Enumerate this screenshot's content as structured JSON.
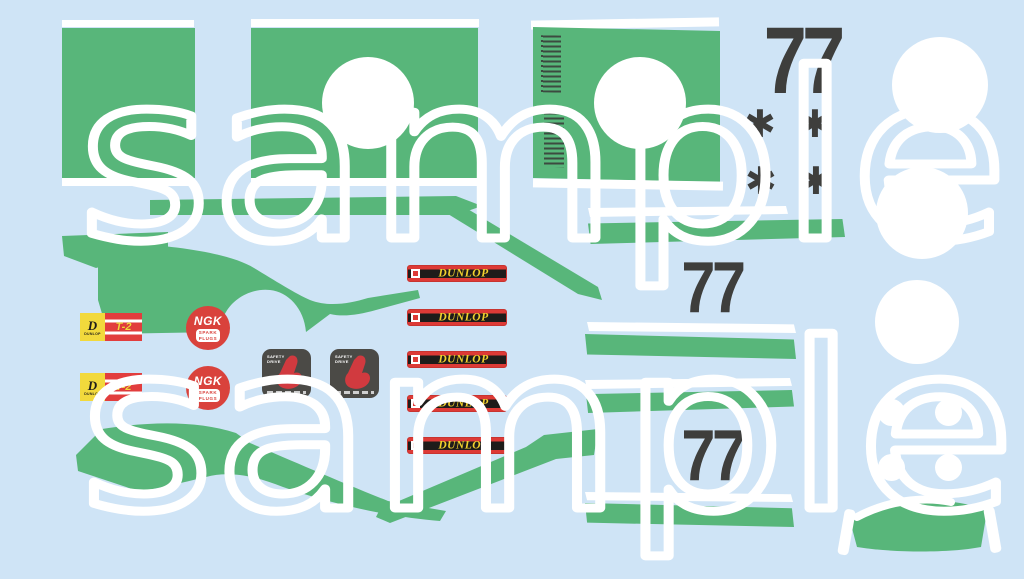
{
  "canvas": {
    "width": 1024,
    "height": 579,
    "background": "#cfe4f6"
  },
  "watermark": {
    "text": "sample",
    "color": "#ffffff"
  },
  "colors": {
    "panel_green": "#58b67a",
    "number_dark": "#3e3e3c",
    "roundel_white": "#ffffff",
    "dunlop_red": "#dd3a36",
    "dunlop_band_black": "#1e1c1a",
    "dunlop_yellow": "#f2d12d",
    "t2_yellow": "#f2d93c",
    "ngk_red": "#d9423c",
    "safety_gray": "#4b4a46",
    "safety_red": "#d13a3f"
  },
  "numbers": {
    "value": "77",
    "count": 3
  },
  "stars": {
    "glyph": "✱",
    "count": 4
  },
  "sponsors": {
    "dunlop_strip": {
      "label": "DUNLOP",
      "count": 5
    },
    "dunlop_t2": {
      "brand": "DUNLOP",
      "code": "T-2",
      "count": 2
    },
    "ngk": {
      "brand": "NGK",
      "line1": "SPARK",
      "line2": "PLUGS",
      "count": 2
    },
    "safety": {
      "line1": "SAFETY",
      "line2": "DRIVE",
      "count": 2
    }
  }
}
